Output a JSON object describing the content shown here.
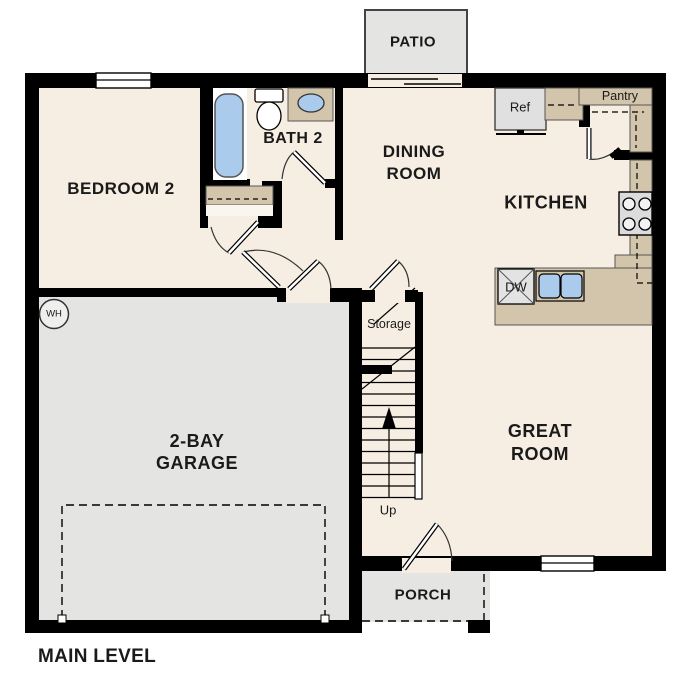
{
  "title": "MAIN LEVEL",
  "colors": {
    "wall": "#000000",
    "floor": "#f6eee3",
    "garage_gray": "#e4e4e2",
    "counter_tan": "#d2c5ab",
    "fixture_blue": "#aacbec",
    "appliance_gray": "#e0e0e0"
  },
  "rooms": {
    "bedroom2": {
      "label": "BEDROOM 2"
    },
    "bath2": {
      "label": "BATH 2"
    },
    "dining": {
      "line1": "DINING",
      "line2": "ROOM"
    },
    "kitchen": {
      "label": "KITCHEN"
    },
    "great_room": {
      "line1": "GREAT",
      "line2": "ROOM"
    },
    "garage": {
      "line1": "2-BAY",
      "line2": "GARAGE"
    },
    "patio": {
      "label": "PATIO"
    },
    "porch": {
      "label": "PORCH"
    },
    "storage": {
      "label": "Storage"
    },
    "pantry": {
      "label": "Pantry"
    }
  },
  "fixtures": {
    "refrigerator": "Ref",
    "dishwasher": "DW",
    "water_heater": "WH",
    "stairs_direction": "Up"
  }
}
